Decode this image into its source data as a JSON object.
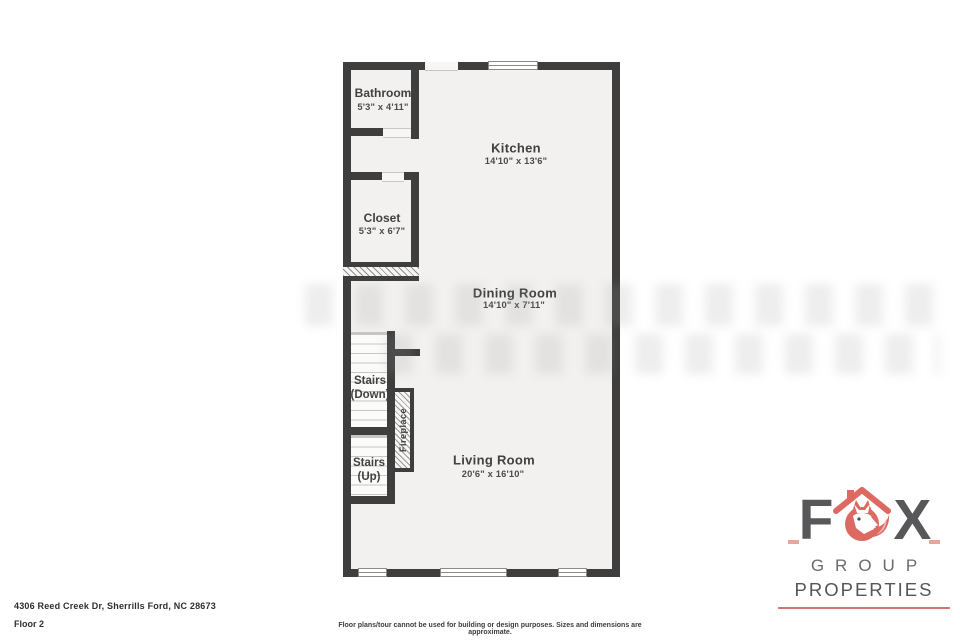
{
  "plan": {
    "rooms": {
      "bathroom": {
        "label": "Bathroom",
        "dims": "5'3\" x 4'11\""
      },
      "kitchen": {
        "label": "Kitchen",
        "dims": "14'10\" x 13'6\""
      },
      "closet": {
        "label": "Closet",
        "dims": "5'3\" x 6'7\""
      },
      "dining": {
        "label": "Dining Room",
        "dims": "14'10\" x 7'11\""
      },
      "living": {
        "label": "Living Room",
        "dims": "20'6\" x 16'10\""
      },
      "stairs_down": {
        "label": "Stairs",
        "sub": "(Down)"
      },
      "stairs_up": {
        "label": "Stairs",
        "sub": "(Up)"
      },
      "fireplace": {
        "label": "Fireplace"
      }
    },
    "colors": {
      "wall": "#3E3E3E",
      "floor": "#F2F1EF"
    }
  },
  "footer": {
    "address": "4306 Reed Creek Dr, Sherrills Ford, NC 28673",
    "floor_label": "Floor 2",
    "disclaimer": "Floor plans/tour cannot be used for building or design purposes. Sizes and dimensions are approximate."
  },
  "logo": {
    "letter_f": "F",
    "letter_x": "X",
    "group": "GROUP",
    "properties": "PROPERTIES",
    "colors": {
      "accent": "#DC6A62",
      "text": "#58585A"
    }
  }
}
